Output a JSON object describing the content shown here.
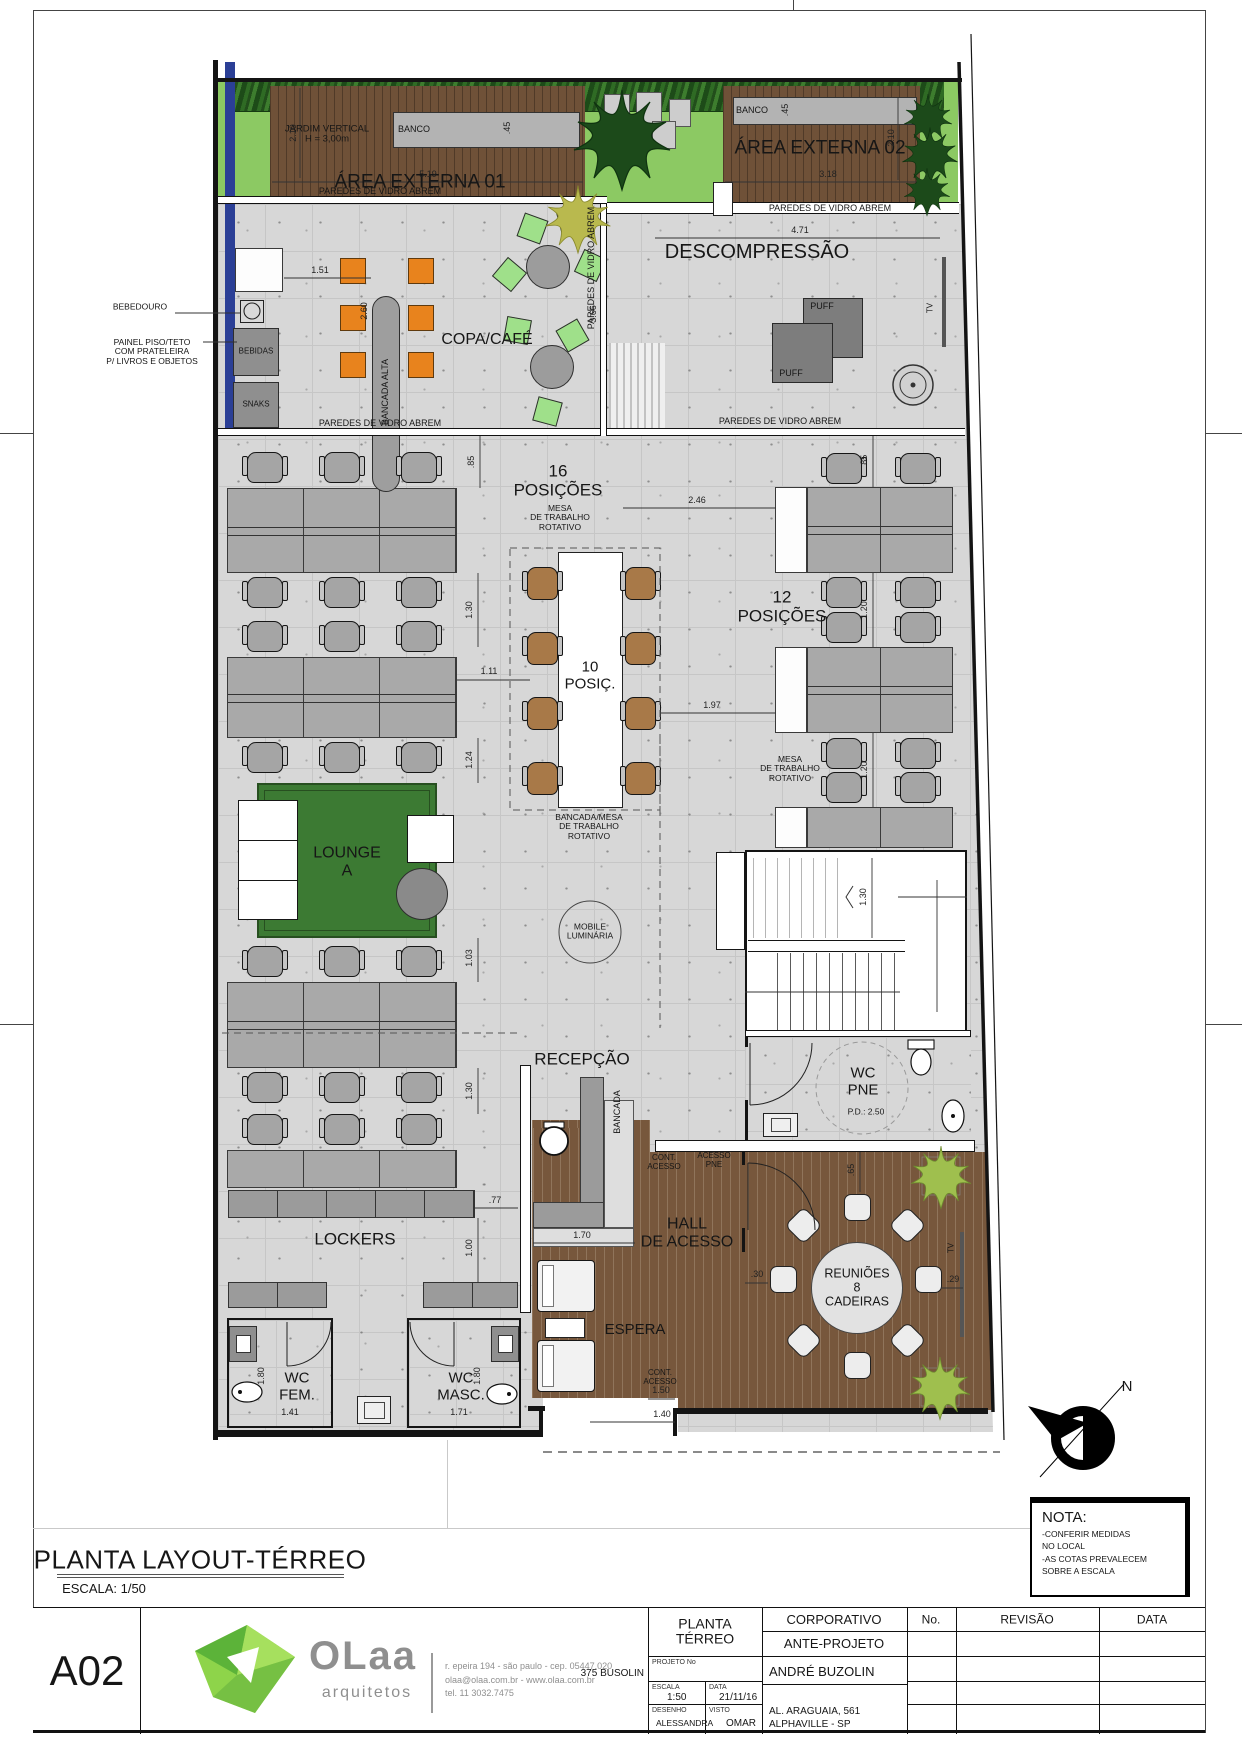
{
  "sheet": {
    "code": "A02",
    "title": "PLANTA LAYOUT-TÉRREO",
    "scale_note": "ESCALA: 1/50",
    "north_label": "N"
  },
  "rooms": {
    "jardim_vertical": "JARDIM VERTICAL\nH = 3,00m",
    "banco": "BANCO",
    "area_externa_01": "ÁREA EXTERNA 01",
    "area_externa_02": "ÁREA EXTERNA 02",
    "paredes_vidro": "PAREDES DE VIDRO ABREM",
    "descompressao": "DESCOMPRESSÃO",
    "puff": "PUFF",
    "tv": "TV",
    "copa_cafe": "COPA/CAFÉ",
    "bancada_alta": "BANCADA ALTA",
    "bebidas": "BEBIDAS",
    "snaks": "SNAKS",
    "pos_16": "16\nPOSIÇÕES",
    "mesa_rotativo": "MESA\nDE TRABALHO\nROTATIVO",
    "pos_12": "12\nPOSIÇÕES",
    "pos_10": "10\nPOSIÇ.",
    "bancada_mesa": "BANCADA/MESA\nDE TRABALHO\nROTATIVO",
    "lounge": "LOUNGE\nA",
    "mobile_luminaria": "MOBILE\nLUMINÁRIA",
    "recepcao": "RECEPÇÃO",
    "bancada": "BANCADA",
    "lockers": "LOCKERS",
    "wc_fem": "WC\nFEM.",
    "wc_masc": "WC\nMASC.",
    "wc_pne": "WC\nPNE",
    "pd_250": "P.D.: 2.50",
    "cont_acesso": "CONT.\nACESSO",
    "acesso_pne": "ACESSO\nPNE",
    "hall": "HALL\nDE ACESSO",
    "espera": "ESPERA",
    "reunioes": "REUNIÕES\n8\nCADEIRAS"
  },
  "callouts": {
    "bebedouro": "BEBEDOURO",
    "painel": "PAINEL PISO/TETO\nCOM PRATELEIRA\nP/ LIVROS E OBJETOS"
  },
  "dims": {
    "area1_w": "5.19",
    "area2_w": "3.18",
    "banco1_d": ".45",
    "banco2_d": ".45",
    "jardim_h": "2.10",
    "area2_h": "2.10",
    "descomp_w": "4.71",
    "copa_gap": "1.51",
    "bancada_l": "2.60",
    "copa_d": "3.66",
    "off_l": ".85",
    "off_r": ".85",
    "b246": "2.46",
    "v130a": "1.30",
    "h111": "1.11",
    "b197": "1.97",
    "v120a": "1.20",
    "v120b": "1.20",
    "stair_w": "1.30",
    "l124": "1.24",
    "l103": "1.03",
    "v130b": "1.30",
    "lock77": ".77",
    "lock100": "1.00",
    "recep170": "1.70",
    "pne65": ".65",
    "reun30": ".30",
    "reun29": ".29",
    "wcf_w": "1.41",
    "wcf_h": "1.80",
    "wcm_w": "1.71",
    "wcm_h": "1.80",
    "ent150": "1.50",
    "ent140": "1.40"
  },
  "nota": {
    "heading": "NOTA:",
    "body": "-CONFERIR MEDIDAS\nNO LOCAL\n-AS COTAS PREVALECEM\nSOBRE A ESCALA"
  },
  "titleblock": {
    "sheet_no": "A02",
    "logo": {
      "name": "OLaa",
      "tagline": "arquitetos",
      "address1": "r. epeira 194 - são paulo - cep. 05447.020",
      "address2": "olaa@olaa.com.br - www.olaa.com.br",
      "address3": "tel. 11 3032.7475"
    },
    "drawing": {
      "name": "PLANTA\nTÉRREO",
      "projeto_label": "PROJETO No",
      "projeto": "375 BUSOLIN",
      "escala_label": "ESCALA",
      "escala": "1:50",
      "data_label": "DATA",
      "data": "21/11/16",
      "desenho_label": "DESENHO",
      "desenho": "ALESSANDRA",
      "visto_label": "VISTO",
      "visto": "OMAR"
    },
    "project": {
      "tipo": "CORPORATIVO",
      "fase": "ANTE-PROJETO",
      "cliente": "ANDRÉ BUZOLIN",
      "endereco": "AL. ARAGUAIA, 561\nALPHAVILLE - SP"
    },
    "revisions": {
      "no": "No.",
      "revisao": "REVISÃO",
      "data": "DATA"
    }
  },
  "colors": {
    "concrete": "#d7d7d7",
    "wood_deck": "#6f5138",
    "wood_floor": "#77573c",
    "grass": "#8cc963",
    "glass_wall_blue": "#2b3f96",
    "stool_orange": "#e8831d",
    "chair_green": "#9fe08a",
    "chair_brown": "#a87948",
    "rug_green": "#3c7a33",
    "logo_green": "#76c043"
  }
}
